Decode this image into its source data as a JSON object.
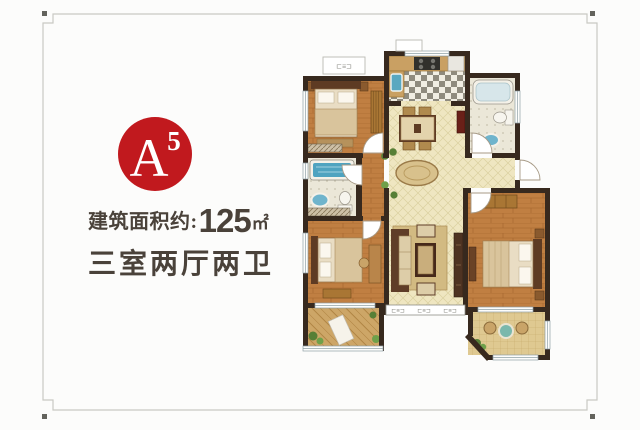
{
  "badge": {
    "main": "A",
    "sup": "5",
    "bg": "#c1191e",
    "fg": "#ffffff"
  },
  "info": {
    "area_label": "建筑面积约:",
    "area_value": "125",
    "area_unit": "㎡",
    "layout_text": "三室两厅两卫"
  },
  "floorplan": {
    "dim_label_top": "⊏≡⊐",
    "sill_labels": [
      "⊏≡⊐",
      "⊏≡⊐",
      "⊏≡⊐"
    ],
    "palette": {
      "wall": "#37291e",
      "wood_floor": "#c07f42",
      "cream_tile": "#efe6c1",
      "bath_tile": "#ebe7d8",
      "water_blue": "#4fa3c0",
      "badge_red": "#c1191e",
      "text_dark": "#4a423a"
    }
  }
}
